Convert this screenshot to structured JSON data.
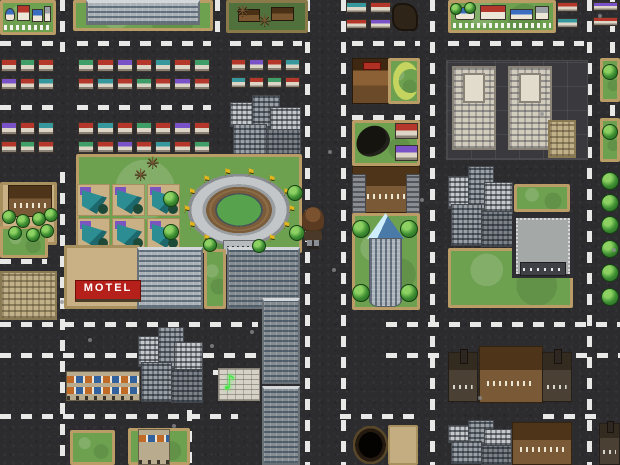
{
  "meta": {
    "width": 620,
    "height": 465,
    "scene": "top-down city tile map"
  },
  "signs": {
    "motel": "MOTEL"
  },
  "glyphs": {
    "flag": "⚑",
    "dead_tree": "✳",
    "neon_sign": "♪"
  },
  "palette": {
    "asphalt": "#2c2c2e",
    "road_dash": "#e8e8e6",
    "grass": "#6da150",
    "tile_border": "#b99c66",
    "motel_red": "#b5201a",
    "stadium_field": "#57a24c",
    "flag_gold": "#e2b41e",
    "neon_green": "#46e846",
    "glass_blue": "#4a7aa8",
    "roof_colors": [
      "#b5372c",
      "#3f9e68",
      "#b5372c",
      "#7a52c8",
      "#b5372c",
      "#36989c"
    ]
  },
  "roads": {
    "h": [
      {
        "y": 43,
        "segments": [
          [
            0,
            56
          ],
          [
            77,
            211
          ],
          [
            230,
            302
          ],
          [
            352,
            420
          ],
          [
            448,
            584
          ]
        ]
      },
      {
        "y": 107,
        "segments": [
          [
            0,
            56
          ],
          [
            77,
            211
          ],
          [
            538,
            586
          ]
        ]
      },
      {
        "y": 117,
        "segments": [
          [
            352,
            420
          ]
        ]
      },
      {
        "y": 261,
        "segments": [
          [
            0,
            47
          ],
          [
            76,
            136
          ]
        ]
      },
      {
        "y": 324,
        "segments": [
          [
            0,
            258
          ],
          [
            386,
            620
          ]
        ]
      },
      {
        "y": 355,
        "segments": [
          [
            0,
            137
          ],
          [
            203,
            262
          ],
          [
            386,
            447
          ],
          [
            576,
            620
          ]
        ]
      },
      {
        "y": 372,
        "segments": [
          [
            213,
            258
          ]
        ]
      },
      {
        "y": 416,
        "segments": [
          [
            0,
            238
          ],
          [
            340,
            417
          ],
          [
            543,
            597
          ]
        ]
      }
    ],
    "v": [
      {
        "x": 62,
        "segments": [
          [
            0,
            52
          ],
          [
            172,
            465
          ]
        ]
      },
      {
        "x": 189,
        "segments": [
          [
            368,
            465
          ]
        ]
      },
      {
        "x": 217,
        "segments": [
          [
            0,
            38
          ]
        ]
      },
      {
        "x": 307,
        "segments": [
          [
            0,
            465
          ]
        ]
      },
      {
        "x": 343,
        "segments": [
          [
            0,
            465
          ]
        ]
      },
      {
        "x": 432,
        "segments": [
          [
            0,
            465
          ]
        ]
      },
      {
        "x": 589,
        "segments": [
          [
            0,
            465
          ]
        ]
      },
      {
        "x": 612,
        "segments": [
          [
            0,
            160
          ]
        ]
      }
    ]
  },
  "village_houses": [
    [
      4,
      16,
      20,
      46,
      "#3a6ec0",
      1
    ],
    [
      28,
      6,
      26,
      56,
      "#b5372c",
      0
    ],
    [
      58,
      22,
      22,
      42,
      "#3a6ec0",
      0
    ],
    [
      82,
      10,
      14,
      54,
      "#9aa0a6",
      0
    ]
  ],
  "cluster_layout": [
    [
      0,
      0.12,
      0.42,
      0.4,
      "a"
    ],
    [
      0.3,
      0,
      0.4,
      0.55,
      "b"
    ],
    [
      0.55,
      0.2,
      0.44,
      0.48,
      "a"
    ],
    [
      0.04,
      0.46,
      0.48,
      0.52,
      "b"
    ],
    [
      0.5,
      0.55,
      0.48,
      0.44,
      "c"
    ]
  ],
  "entities": [
    {
      "name": "village-tile-topleft",
      "type": "village",
      "x": 0,
      "y": 0,
      "w": 56,
      "h": 35
    },
    {
      "name": "office-lawn-top",
      "type": "grass",
      "x": 73,
      "y": 0,
      "w": 140,
      "h": 31
    },
    {
      "name": "office-building-top",
      "type": "office",
      "x": 86,
      "y": 0,
      "w": 114,
      "h": 25
    },
    {
      "name": "ruined-village-tile",
      "type": "ruins",
      "x": 226,
      "y": 0,
      "w": 82,
      "h": 33
    },
    {
      "name": "house-row-1",
      "type": "houserow",
      "x": 0,
      "y": 57,
      "w": 56,
      "h": 37,
      "seed": 0
    },
    {
      "name": "house-row-2",
      "type": "houserow",
      "x": 77,
      "y": 57,
      "w": 135,
      "h": 37,
      "seed": 1
    },
    {
      "name": "house-row-3",
      "type": "houserow",
      "x": 230,
      "y": 57,
      "w": 72,
      "h": 35,
      "seed": 2
    },
    {
      "name": "house-row-4",
      "type": "houserow",
      "x": 0,
      "y": 120,
      "w": 56,
      "h": 37,
      "seed": 3
    },
    {
      "name": "house-row-5",
      "type": "houserow",
      "x": 77,
      "y": 120,
      "w": 135,
      "h": 37,
      "seed": 4
    },
    {
      "name": "city-cluster-north",
      "type": "citycluster",
      "x": 230,
      "y": 95,
      "w": 72,
      "h": 62
    },
    {
      "name": "stadium-lawn",
      "type": "grass",
      "x": 76,
      "y": 154,
      "w": 226,
      "h": 99
    },
    {
      "name": "suburb-tile-grid",
      "type": "suburbrow",
      "x": 76,
      "y": 183,
      "w": 106,
      "h": 70
    },
    {
      "name": "stadium",
      "type": "stadium",
      "x": 178,
      "y": 167,
      "w": 122,
      "h": 86,
      "flags": 14
    },
    {
      "name": "mansion-grove-tile",
      "type": "tan",
      "x": 0,
      "y": 182,
      "w": 57,
      "h": 63
    },
    {
      "name": "mansion-left",
      "type": "mansion",
      "x": 8,
      "y": 185,
      "w": 44,
      "h": 32
    },
    {
      "name": "grass-square-left",
      "type": "grass",
      "x": 0,
      "y": 226,
      "w": 48,
      "h": 32
    },
    {
      "name": "motel-grounds",
      "type": "tan",
      "x": 64,
      "y": 245,
      "w": 76,
      "h": 64
    },
    {
      "name": "office-center-west",
      "type": "office",
      "x": 137,
      "y": 247,
      "w": 66,
      "h": 62
    },
    {
      "name": "office-lawn-strip",
      "type": "grass",
      "x": 204,
      "y": 249,
      "w": 22,
      "h": 60
    },
    {
      "name": "office-center-east",
      "type": "office",
      "cls": "dark",
      "x": 227,
      "y": 247,
      "w": 73,
      "h": 62
    },
    {
      "name": "apartments-left",
      "type": "sand",
      "x": 0,
      "y": 271,
      "w": 57,
      "h": 49
    },
    {
      "name": "tower-mid",
      "type": "office",
      "cls": "dark",
      "x": 262,
      "y": 298,
      "w": 38,
      "h": 86
    },
    {
      "name": "tower-south",
      "type": "office",
      "cls": "dark",
      "x": 262,
      "y": 386,
      "w": 38,
      "h": 79
    },
    {
      "name": "city-cluster-west",
      "type": "citycluster",
      "x": 138,
      "y": 327,
      "w": 66,
      "h": 77
    },
    {
      "name": "awning-shops",
      "type": "shops",
      "x": 66,
      "y": 371,
      "w": 74,
      "h": 30
    },
    {
      "name": "neon-sign-building",
      "type": "brick",
      "x": 218,
      "y": 368,
      "w": 42,
      "h": 33
    },
    {
      "name": "grass-square-sw1",
      "type": "grass",
      "x": 70,
      "y": 430,
      "w": 45,
      "h": 35
    },
    {
      "name": "grass-square-sw2",
      "type": "grass",
      "x": 128,
      "y": 428,
      "w": 62,
      "h": 37
    },
    {
      "name": "shop-south",
      "type": "shops",
      "cls": "single",
      "x": 138,
      "y": 429,
      "w": 32,
      "h": 36
    },
    {
      "name": "house-row-tr1",
      "type": "houserow",
      "x": 345,
      "y": 0,
      "w": 48,
      "h": 33,
      "seed": 5
    },
    {
      "name": "ruined-house",
      "type": "ruinh",
      "x": 392,
      "y": 3,
      "w": 26,
      "h": 28
    },
    {
      "name": "village-tile-topright",
      "type": "village",
      "x": 448,
      "y": 0,
      "w": 108,
      "h": 33
    },
    {
      "name": "house-row-tr2",
      "type": "houserow",
      "x": 556,
      "y": 0,
      "w": 24,
      "h": 32,
      "seed": 2
    },
    {
      "name": "house-row-tr3",
      "type": "houserow",
      "x": 592,
      "y": 0,
      "w": 28,
      "h": 30,
      "seed": 3
    },
    {
      "name": "inn-building",
      "type": "inn",
      "x": 352,
      "y": 58,
      "w": 38,
      "h": 46
    },
    {
      "name": "inn-lawn",
      "type": "grass",
      "x": 388,
      "y": 58,
      "w": 32,
      "h": 46
    },
    {
      "name": "crescent-lawn-mark",
      "type": "crescent",
      "x": 393,
      "y": 62,
      "w": 26,
      "h": 38
    },
    {
      "name": "stable-tile",
      "type": "grass",
      "x": 352,
      "y": 120,
      "w": 68,
      "h": 46
    },
    {
      "name": "dark-creature",
      "type": "creature",
      "x": 356,
      "y": 126,
      "w": 34,
      "h": 30
    },
    {
      "name": "house-pair-red",
      "type": "houserow",
      "x": 394,
      "y": 121,
      "w": 26,
      "h": 44,
      "seed": 0
    },
    {
      "name": "palace-hotel",
      "type": "mansion",
      "cls": "palace",
      "x": 352,
      "y": 166,
      "w": 68,
      "h": 47
    },
    {
      "name": "tower-lawn",
      "type": "grass",
      "x": 352,
      "y": 213,
      "w": 68,
      "h": 97
    },
    {
      "name": "glass-tower",
      "type": "glasstower",
      "x": 367,
      "y": 213,
      "w": 37,
      "h": 94
    },
    {
      "name": "plaza-twin-towers",
      "type": "plaza",
      "x": 446,
      "y": 60,
      "w": 142,
      "h": 100
    },
    {
      "name": "twin-tower-west",
      "type": "twin",
      "x": 452,
      "y": 66,
      "w": 44,
      "h": 84
    },
    {
      "name": "twin-tower-east",
      "type": "twin",
      "x": 508,
      "y": 66,
      "w": 44,
      "h": 84
    },
    {
      "name": "tan-annex",
      "type": "sand",
      "x": 548,
      "y": 120,
      "w": 28,
      "h": 38
    },
    {
      "name": "grass-right-1",
      "type": "grass",
      "x": 600,
      "y": 58,
      "w": 20,
      "h": 44
    },
    {
      "name": "grass-right-2",
      "type": "grass",
      "x": 600,
      "y": 118,
      "w": 20,
      "h": 44
    },
    {
      "name": "city-cluster-east",
      "type": "citycluster",
      "x": 448,
      "y": 166,
      "w": 66,
      "h": 82
    },
    {
      "name": "grass-patch-ne",
      "type": "grass",
      "x": 514,
      "y": 184,
      "w": 56,
      "h": 28
    },
    {
      "name": "big-lawn-se",
      "type": "grass",
      "x": 448,
      "y": 248,
      "w": 125,
      "h": 60
    },
    {
      "name": "walled-compound",
      "type": "compound",
      "x": 512,
      "y": 214,
      "w": 62,
      "h": 64
    },
    {
      "name": "church-west",
      "type": "church",
      "x": 448,
      "y": 352,
      "w": 30,
      "h": 50
    },
    {
      "name": "manor-south",
      "type": "mansion",
      "x": 479,
      "y": 346,
      "w": 64,
      "h": 57
    },
    {
      "name": "church-east",
      "type": "church",
      "x": 542,
      "y": 352,
      "w": 30,
      "h": 50
    },
    {
      "name": "city-cluster-south",
      "type": "citycluster",
      "x": 448,
      "y": 420,
      "w": 65,
      "h": 45
    },
    {
      "name": "manor-south-2",
      "type": "mansion",
      "x": 512,
      "y": 422,
      "w": 60,
      "h": 43
    },
    {
      "name": "church-edge",
      "type": "church",
      "x": 599,
      "y": 423,
      "w": 21,
      "h": 42
    },
    {
      "name": "pit-hole",
      "type": "pit",
      "x": 353,
      "y": 426,
      "w": 35,
      "h": 38
    },
    {
      "name": "sand-patch",
      "type": "tan",
      "cls": "bare",
      "x": 388,
      "y": 425,
      "w": 30,
      "h": 40
    }
  ],
  "trees": [
    [
      163,
      191,
      16
    ],
    [
      287,
      185,
      16
    ],
    [
      289,
      225,
      16
    ],
    [
      163,
      224,
      16
    ],
    [
      203,
      238,
      14
    ],
    [
      252,
      239,
      14
    ],
    [
      352,
      220,
      18
    ],
    [
      400,
      220,
      18
    ],
    [
      352,
      284,
      18
    ],
    [
      400,
      284,
      18
    ],
    [
      601,
      172,
      18
    ],
    [
      601,
      194,
      18
    ],
    [
      601,
      216,
      18
    ],
    [
      601,
      240,
      18
    ],
    [
      601,
      264,
      18
    ],
    [
      601,
      288,
      18
    ],
    [
      602,
      64,
      16
    ],
    [
      602,
      124,
      16
    ],
    [
      2,
      210,
      14
    ],
    [
      16,
      214,
      14
    ],
    [
      32,
      212,
      14
    ],
    [
      44,
      208,
      14
    ],
    [
      8,
      226,
      14
    ],
    [
      26,
      228,
      14
    ],
    [
      40,
      224,
      14
    ],
    [
      450,
      3,
      12
    ],
    [
      464,
      2,
      12
    ]
  ],
  "dead_trees": [
    [
      146,
      156
    ],
    [
      134,
      168
    ],
    [
      258,
      14
    ],
    [
      236,
      4
    ]
  ],
  "speckles": [
    [
      598,
      14
    ],
    [
      540,
      112
    ],
    [
      420,
      198
    ],
    [
      88,
      338
    ],
    [
      210,
      344
    ],
    [
      172,
      424
    ],
    [
      478,
      396
    ],
    [
      612,
      248
    ],
    [
      328,
      150
    ],
    [
      332,
      268
    ],
    [
      60,
      300
    ],
    [
      250,
      330
    ]
  ],
  "player": {
    "x": 301,
    "y": 207,
    "description": "long-haired traveler standing on the central avenue"
  }
}
